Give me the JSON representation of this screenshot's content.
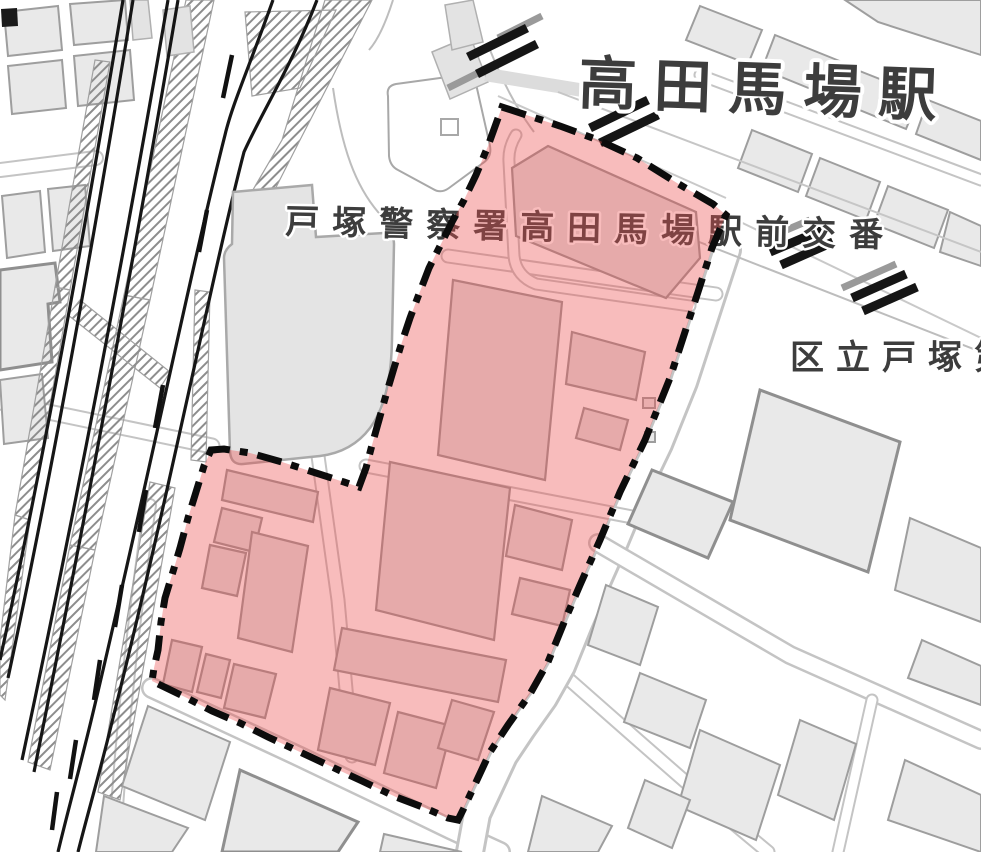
{
  "map": {
    "labels": {
      "station": {
        "text": "高田馬場駅"
      },
      "police_box": {
        "text": "戸塚警察署高田馬場駅前交番"
      },
      "school_partial": {
        "text": "区立戸塚第"
      }
    },
    "highlight_zone": {
      "fill_color": "#ec5050",
      "fill_opacity": "0.38",
      "border_color": "#0c0c0c",
      "border_style": "dash-dot"
    },
    "base_colors": {
      "background": "#ffffff",
      "building_fill": "#e9e9e9",
      "building_stroke": "#9e9e9e",
      "railway_line": "#161616",
      "label_text": "#3d3d3d",
      "label_halo": "#ffffff"
    }
  }
}
